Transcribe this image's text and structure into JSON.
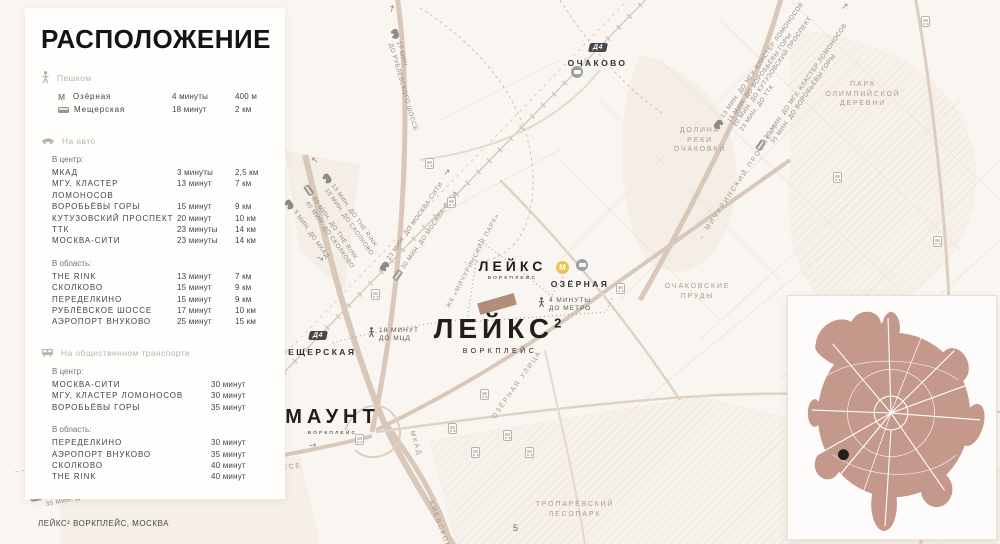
{
  "page": {
    "footer": "ЛЕЙКС² ВОРКПЛЕЙС, МОСКВА",
    "page_number": "5"
  },
  "panel": {
    "title": "РАСПОЛОЖЕНИЕ",
    "walk": {
      "label": "Пешком",
      "rows": [
        {
          "glyph": "М",
          "name": "Озёрная",
          "time": "4 минуты",
          "dist": "400 м"
        },
        {
          "name": "Мещерская",
          "time": "18 минут",
          "dist": "2 км"
        }
      ]
    },
    "car": {
      "label": "На авто",
      "center": {
        "heading": "В центр:",
        "rows": [
          {
            "name": "МКАД",
            "time": "3 минуты",
            "dist": "2,5 км"
          },
          {
            "name": "МГУ, КЛАСТЕР ЛОМОНОСОВ",
            "time": "13 минут",
            "dist": "7 км"
          },
          {
            "name": "ВОРОБЬЁВЫ ГОРЫ",
            "time": "15 минут",
            "dist": "9 км"
          },
          {
            "name": "КУТУЗОВСКИЙ ПРОСПЕКТ",
            "time": "20 минут",
            "dist": "10 км"
          },
          {
            "name": "ТТК",
            "time": "23 минуты",
            "dist": "14 км"
          },
          {
            "name": "МОСКВА-СИТИ",
            "time": "23 минуты",
            "dist": "14 км"
          }
        ]
      },
      "region": {
        "heading": "В область:",
        "rows": [
          {
            "name": "THE RINK",
            "time": "13 минут",
            "dist": "7 км"
          },
          {
            "name": "СКОЛКОВО",
            "time": "15 минут",
            "dist": "9 км"
          },
          {
            "name": "ПЕРЕДЕЛКИНО",
            "time": "15 минут",
            "dist": "9 км"
          },
          {
            "name": "РУБЛЁВСКОЕ ШОССЕ",
            "time": "17 минут",
            "dist": "10 км"
          },
          {
            "name": "АЭРОПОРТ ВНУКОВО",
            "time": "25 минут",
            "dist": "15 км"
          }
        ]
      }
    },
    "transit": {
      "label": "На общественном транспорте",
      "center": {
        "heading": "В центр:",
        "rows": [
          {
            "name": "МОСКВА-СИТИ",
            "time": "30 минут"
          },
          {
            "name": "МГУ, КЛАСТЕР ЛОМОНОСОВ",
            "time": "30 минут"
          },
          {
            "name": "ВОРОБЬЁВЫ ГОРЫ",
            "time": "35 минут"
          }
        ]
      },
      "region": {
        "heading": "В область:",
        "rows": [
          {
            "name": "ПЕРЕДЕЛКИНО",
            "time": "30 минут"
          },
          {
            "name": "АЭРОПОРТ ВНУКОВО",
            "time": "35 минут"
          },
          {
            "name": "СКОЛКОВО",
            "time": "40 минут"
          },
          {
            "name": "THE RINK",
            "time": "40 минут"
          }
        ]
      }
    }
  },
  "map": {
    "stations": {
      "ochakovo": {
        "badge": "Д4",
        "name": "ОЧАКОВО"
      },
      "meshcherskaya": {
        "badge": "Д4",
        "name": "МЕЩЕРСКАЯ"
      },
      "ozernaya": {
        "metro": "М",
        "name": "ОЗЁРНАЯ"
      },
      "govorovo": {
        "metro": "М",
        "name": "ГОВОРОВО"
      }
    },
    "areas": {
      "dolina": {
        "l1": "ДОЛИНА",
        "l2": "РЕКИ",
        "l3": "ОЧАКОВКИ"
      },
      "park_olymp": {
        "l1": "ПАРК",
        "l2": "ОЛИМПИЙСКОЙ",
        "l3": "ДЕРЕВНИ"
      },
      "prudy": {
        "l1": "ОЧАКОВСКИЕ",
        "l2": "ПРУДЫ"
      },
      "troparevsky": {
        "l1": "ТРОПАРЁВСКИЙ",
        "l2": "ЛЕСОПАРК"
      }
    },
    "roads": {
      "michurinsky": "МИЧУРИНСКИЙ ПРОСПЕКТ",
      "ozernaya_ul": "ОЗЁРНАЯ УЛИЦА",
      "borovskoe": "БОРОВСКОЕ ШОССЕ",
      "kievskoe": "КИЕВСКОЕ Ш.",
      "mkad": "МКАД"
    },
    "district": "ЖК «МИЧУРИНСКИЙ ПАРК»",
    "projects": {
      "leiks": {
        "name": "ЛЕЙКС",
        "sub": "ВОРКПЛЕЙС"
      },
      "leiks2": {
        "name": "ЛЕЙКС",
        "sup": "2",
        "sub": "ВОРКПЛЕЙС"
      },
      "maunt": {
        "name": "МАУНТ",
        "sub": "ВОРКПЛЕЙС"
      }
    },
    "walk_notes": {
      "metro": {
        "l1": "4 МИНУТЫ",
        "l2": "ДО МЕТРО"
      },
      "mcd": {
        "l1": "18 МИНУТ",
        "l2": "ДО МЦД"
      }
    },
    "route_notes": {
      "rublevskoe": {
        "l1": "17 МИН.",
        "l2": "ДО РУБЛЁВСКОГО ШОССЕ"
      },
      "ne_car": {
        "l1": "13 МИН. ДО МГУ, КЛАСТЕР ЛОМОНОСОВ",
        "l2": "15 МИН. ДО ВОРОБЬЁВЫ ГОРЫ",
        "l3": "20 МИН. ДО КУТУЗОВСКИЙ ПРОСПЕКТ",
        "l4": "23 МИН. ДО ТТК"
      },
      "ne_bus": {
        "l1": "30 МИН. ДО МГУ, КЛАСТЕР ЛОМОНОСОВ",
        "l2": "35 МИН. ДО ВОРОБЬЁВЫ ГОРЫ"
      },
      "city_car": {
        "l1": "23 МИН. ДО МОСКВА-СИТИ"
      },
      "city_bus": {
        "l1": "30 МИН. ДО МОСКВА-СИТИ"
      },
      "rink_car": {
        "l1": "13 МИН. ДО THE RINK",
        "l2": "15 МИН. ДО СКОЛКОВО"
      },
      "rink_bus": {
        "l1": "40 МИН. ДО THE RINK",
        "l2": "40 МИН. ДО СКОЛКОВО"
      },
      "mkad_car": {
        "l1": "3 МИН. ДО МКАД"
      },
      "sw_car": {
        "l1": "15 МИН. ДО ПЕРЕДЕЛКИНО",
        "l2": "25 МИН. ДО АЭРОПОРТА ВНУКОВО"
      },
      "sw_bus": {
        "l1": "30 МИН. ДО ПЕРЕДЕЛКИНО",
        "l2": "35 МИН. ДО АЭРОПОРТА ВНУКОВО"
      }
    },
    "arrows": {
      "up": "↑",
      "up_right": "↗",
      "up_left": "↖",
      "right": "→",
      "left": "←"
    }
  },
  "colors": {
    "accent_brown": "#c4988b",
    "road": "#d9c8ba",
    "metro_yellow": "#ecc14d",
    "badge_dark": "#45494c",
    "ink": "#1f1e1c"
  }
}
